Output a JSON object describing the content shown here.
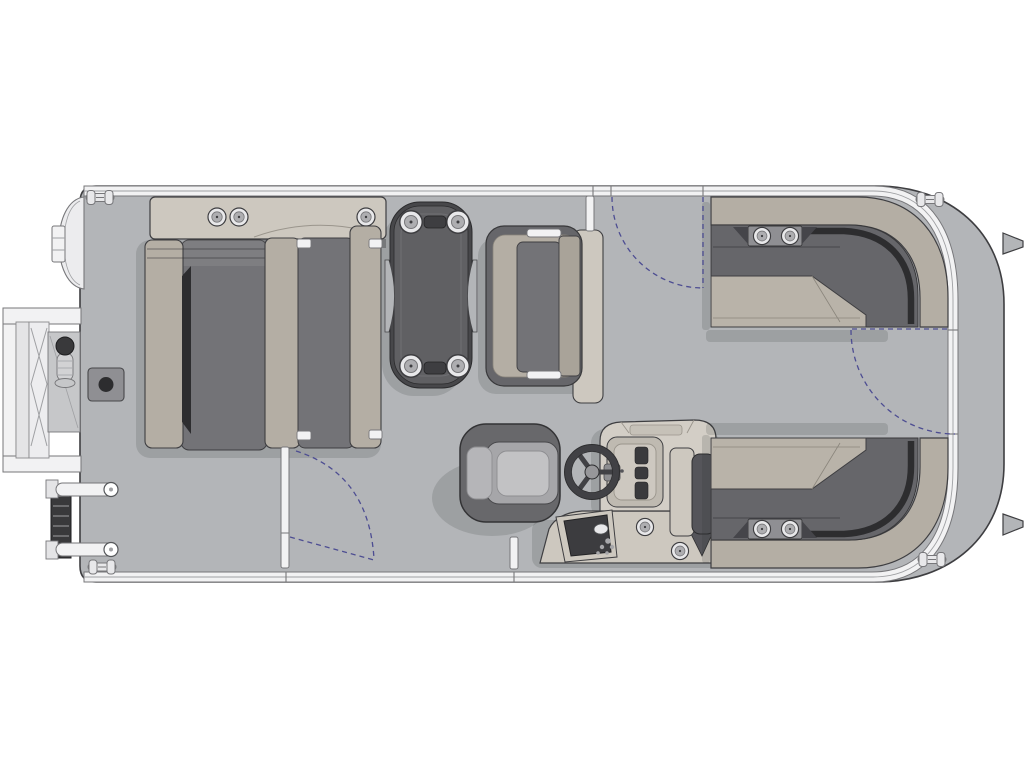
{
  "diagram": {
    "kind": "pontoon-boat-floor-plan",
    "view": "top-down-deck-plan",
    "orientation": "bow-left-stern-right",
    "canvas": {
      "width": 1024,
      "height": 768
    }
  },
  "palette": {
    "page_bg": "#ffffff",
    "deck": "#b3b5b8",
    "rail": "#f2f2f3",
    "outline": "#3e3e41",
    "outline_mid": "#77777a",
    "tan": "#b4aea4",
    "tan_light": "#cdc8bf",
    "tan_seat": "#b9b3a9",
    "cushion_mid": "#737377",
    "cushion_dark": "#66666a",
    "near_black": "#2d2d2f",
    "table_top": "#606063",
    "table_rim": "#47474a",
    "trim_light": "#ececee",
    "hardware": "#8f8f93",
    "hardware_light": "#e8e8ea",
    "arc": "#4d4d92",
    "shadow": "rgba(45,47,50,0.16)"
  },
  "parts": {
    "hull": {
      "name": "pontoon deck with perimeter fence rail",
      "cleats": 4,
      "motor_mount_brackets": 2
    },
    "bow_platform": {
      "name": "bow boarding platform with fold-out ladder and tow pylon"
    },
    "folded_ladder": {
      "name": "folded boarding ladder at port bow corner"
    },
    "bow_lounge": {
      "name": "back-to-back bow lounge with armrest console",
      "cup_holders": 3
    },
    "table": {
      "name": "cocktail table",
      "cup_holders": 4,
      "accessory_slots": 2
    },
    "companion_bench": {
      "name": "flip-back companion bench seat"
    },
    "captains_chair": {
      "name": "captain's helm chair"
    },
    "helm_console": {
      "name": "helm console with steering wheel, gauge panel and switch panel",
      "cup_holders": 2
    },
    "stern_lounge_top": {
      "name": "aft wraparound L-lounge, starboard top",
      "cup_holders": 2
    },
    "stern_lounge_bottom": {
      "name": "aft wraparound L-lounge, mirrored bottom",
      "cup_holders": 2
    },
    "latch_plate": {
      "name": "deck latch plate near bow gate"
    }
  },
  "gates": [
    {
      "name": "bow side gate",
      "location": "top rail",
      "swing": "inward quarter arc"
    },
    {
      "name": "port side gate",
      "location": "bottom rail",
      "swing": "inward quarter arc"
    },
    {
      "name": "stern gate",
      "location": "right rail",
      "swing": "inward quarter arc"
    }
  ]
}
